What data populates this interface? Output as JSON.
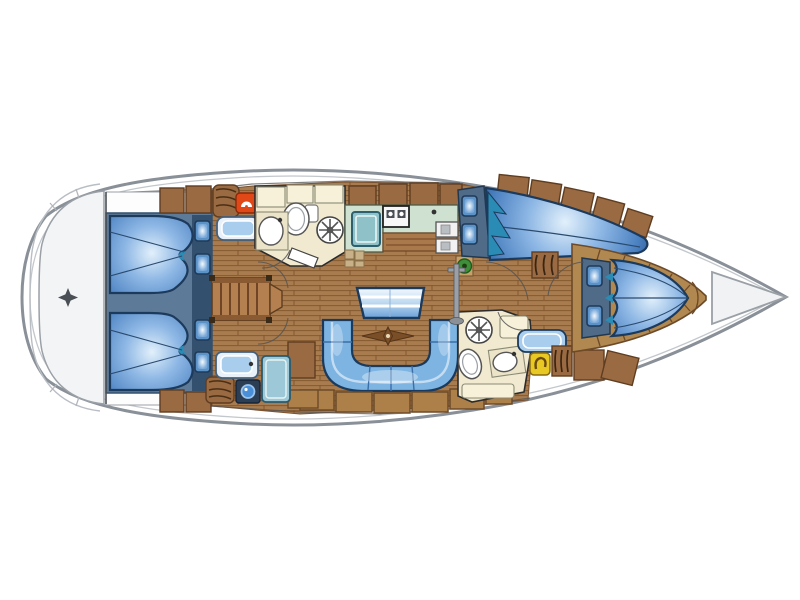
{
  "diagram": {
    "title": "Sailing yacht interior layout plan (top view)",
    "type": "boat-floor-plan",
    "orientation": {
      "bow": "right",
      "stern": "left"
    },
    "counts": {
      "cabins": 4,
      "double_berths": 4,
      "heads": 2,
      "pillows": 8
    }
  },
  "rooms": [
    {
      "name": "Stern / swim platform",
      "features": [
        "transom",
        "compass-emblem"
      ]
    },
    {
      "name": "Aft double cabin (starboard)",
      "features": [
        "fan-shaped double berth",
        "2 pillows",
        "hanging locker",
        "seat cushion",
        "red fixture"
      ]
    },
    {
      "name": "Aft double cabin (port)",
      "features": [
        "fan-shaped double berth",
        "2 pillows",
        "hanging locker",
        "washbasin",
        "blue fixture"
      ]
    },
    {
      "name": "Companionway steps",
      "features": [
        "6 treads",
        "landing"
      ]
    },
    {
      "name": "Aft head",
      "features": [
        "toilet",
        "washbasin",
        "shower drain",
        "door"
      ]
    },
    {
      "name": "Galley",
      "features": [
        "2-burner stove",
        "teal sink",
        "refrigerator unit",
        "overhead lockers",
        "drawer front"
      ]
    },
    {
      "name": "Salon",
      "features": [
        "folding table",
        "U-shaped settee",
        "compass floor inlay",
        "locker row",
        "mast post",
        "plank floor"
      ]
    },
    {
      "name": "Navigation corner",
      "features": [
        "instrument boxes",
        "plant on pedestal"
      ]
    },
    {
      "name": "Forward double cabin (starboard)",
      "features": [
        "angled double berth",
        "2 pillows",
        "teal drape",
        "louvered locker",
        "hull-side lockers"
      ]
    },
    {
      "name": "Forward head",
      "features": [
        "toilet",
        "washbasin",
        "shower drain",
        "cream cabinets"
      ]
    },
    {
      "name": "Forward passageway",
      "features": [
        "seat cushion",
        "yellow fixture",
        "louvered locker",
        "lockers"
      ]
    },
    {
      "name": "Bow V-berth cabin",
      "features": [
        "scalloped V-berth",
        "2 pillows",
        "wooden shelf surround"
      ]
    },
    {
      "name": "Anchor locker",
      "features": [
        "bow stowage triangle"
      ]
    }
  ],
  "palette": {
    "hull_stroke": "#8a9098",
    "hull_fill": "#ffffff",
    "transom_fill": "#f3f4f6",
    "slate": "#5d7a98",
    "slate_dark": "#33506e",
    "berth_edge": "#1c3a5c",
    "berth_mid": "#5b92cc",
    "berth_light": "#d9ebfa",
    "berth_teal": "#2a8cb5",
    "pillow_border": "#1f3a58",
    "pillow_center": "#eaf4fd",
    "wood": "#a87c4e",
    "wood_line": "#85592f",
    "locker_brown": "#9a6b42",
    "locker_dark": "#5f3d20",
    "shelf_tan": "#b08850",
    "shelf_seam": "#6d4a28",
    "cream": "#f1ead0",
    "cream_cabinet": "#f7f1da",
    "galley_green": "#cfe2d2",
    "sink_teal": "#8fc2c8",
    "settee_blue": "#7db4e2",
    "settee_light": "#c4dcf2",
    "accent_red": "#e04818",
    "accent_yellow": "#e8c822",
    "accent_green": "#3f8f3a",
    "outline": "#2b2b2b"
  }
}
